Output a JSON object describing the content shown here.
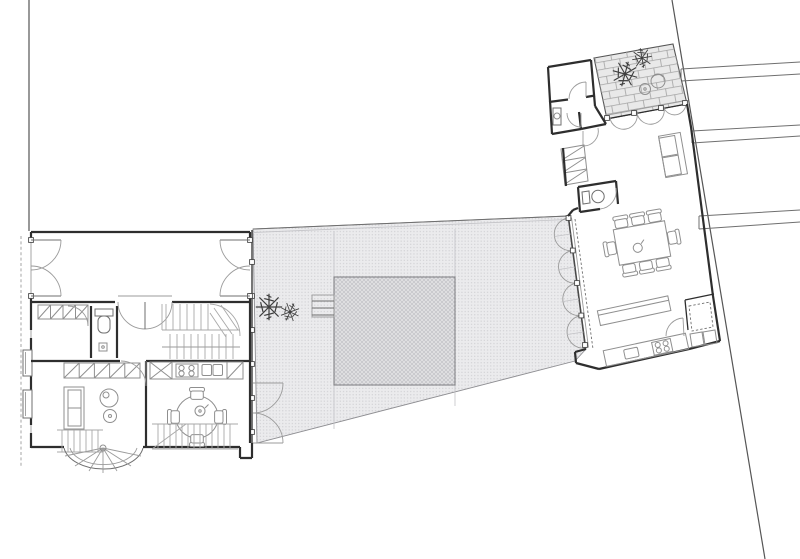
{
  "page": {
    "label": "Architectural ground-floor plan: two buildings connected by a paved courtyard",
    "background": "#ffffff"
  },
  "palette": {
    "wall": "#2e2e2e",
    "line": "#6f6f6f",
    "thin": "#9b9b9b",
    "ghost": "#c3c3c7",
    "stair": "#a9a9a9",
    "furn": "#8f8f8f",
    "plant": "#3f3f3f",
    "fixture-fill": "#ffffff",
    "paving-bg": "#ebebed",
    "paving-dot": "#cdcdd1",
    "hatch-bg": "#e2e2e4",
    "hatch-line": "#c2c2c6",
    "brick-bg": "#e9e9e9",
    "brick-joint": "#a3a3a3"
  },
  "site": {
    "property_line_left": "vertical line, top edge to left building corner",
    "property_line_right": "diagonal line, full height",
    "neighbor_party_walls": 3,
    "sidewalk_dashes": 2
  },
  "left_building": {
    "rooms": [
      "front-room-with-double-doors",
      "closet-room",
      "wc",
      "stair-hall",
      "living-room",
      "kitchen-dining"
    ],
    "fixtures": [
      "wardrobe-hatched-4-cells",
      "wardrobe-hatched-5-cells",
      "toilet",
      "sofa-2-seat",
      "armchair-round",
      "side-table-round",
      "round-table-4-chairs",
      "stove-4-burner",
      "sink-double",
      "stair-straight",
      "stair-lower",
      "stair-spiral-turret",
      "double-swing-door",
      "french-doors-left",
      "french-doors-right"
    ]
  },
  "courtyard": {
    "paving": "stippled",
    "central-square": "cross-hatched paving panel",
    "steps": "4 treads at west side of square",
    "plants": 2,
    "folding-door-arcs-east": 4,
    "french-door-arcs-west": 2
  },
  "right_building": {
    "rooms": [
      "storage-room",
      "bathroom",
      "closet-hatched",
      "wc",
      "dining-living-room",
      "kitchen",
      "utility-room"
    ],
    "fixtures": [
      "terrace-brick-paving",
      "plants-2",
      "bistro-table",
      "garden-chair",
      "dining-table-8-chairs",
      "teapot",
      "sofa-2-seat",
      "kitchen-island",
      "counter-with-sink-and-4-burner-stove",
      "skylight-dashed",
      "appliances-2",
      "sink-basin",
      "toilet",
      "glazed-door-arcs-3"
    ]
  }
}
